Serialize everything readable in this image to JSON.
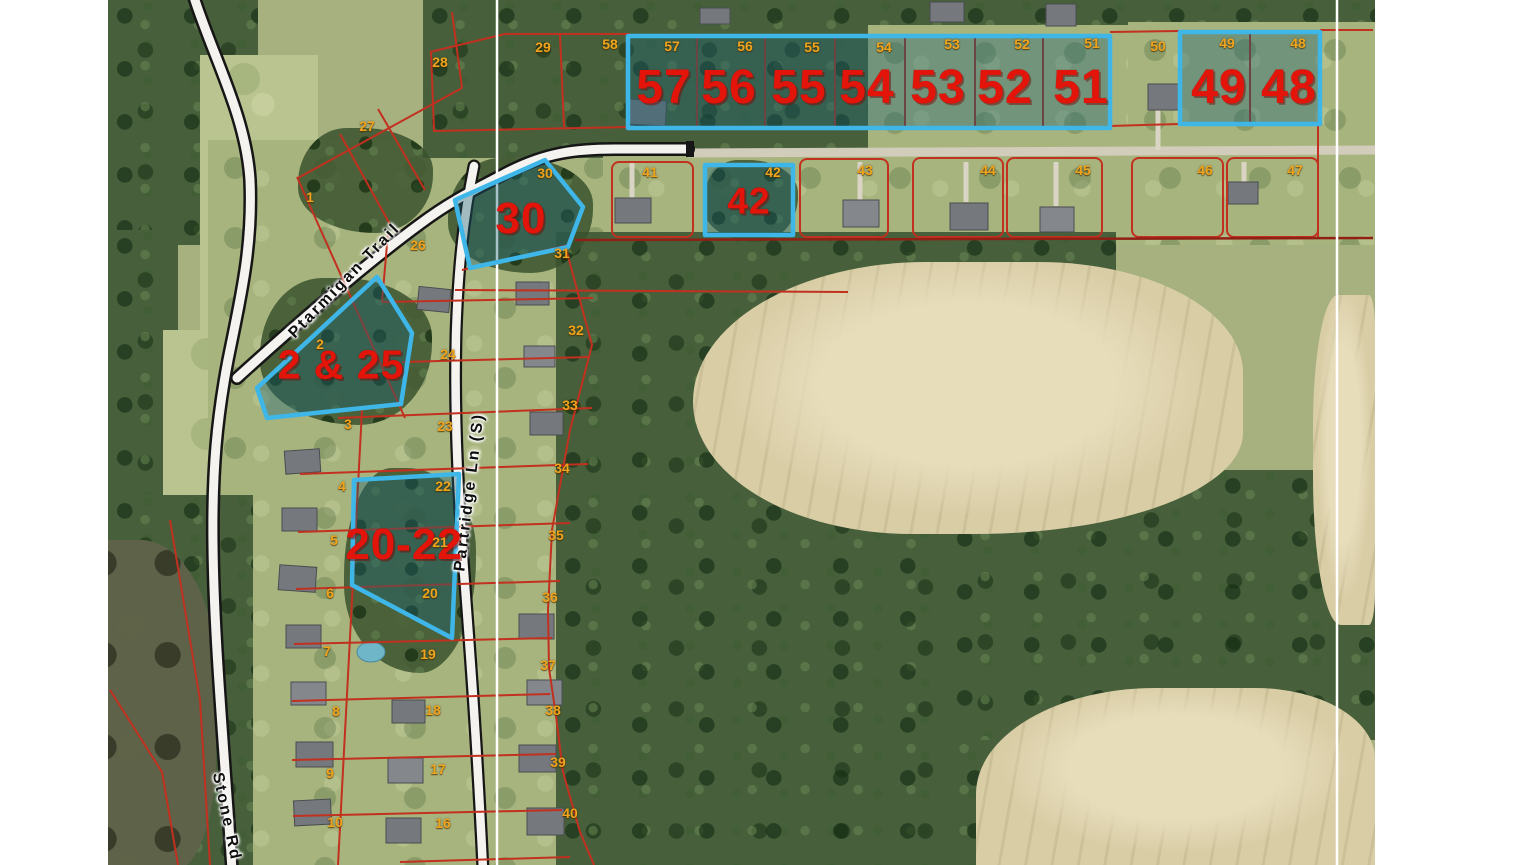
{
  "map": {
    "description": "Aerial plat map with red parcel boundaries and blue-highlighted lots for sale",
    "streets": {
      "ptarmigan": "Ptarmigan Trail",
      "partridge": "Partridge Ln (S)",
      "stone": "Stone Rd"
    },
    "highlighted_parcels": [
      {
        "label": "57"
      },
      {
        "label": "56"
      },
      {
        "label": "55"
      },
      {
        "label": "54"
      },
      {
        "label": "53"
      },
      {
        "label": "52"
      },
      {
        "label": "51"
      },
      {
        "label": "49"
      },
      {
        "label": "48"
      },
      {
        "label": "30"
      },
      {
        "label": "42"
      },
      {
        "label": "2 & 25"
      },
      {
        "label": "20-22"
      }
    ],
    "lot_numbers": [
      {
        "n": "29"
      },
      {
        "n": "58"
      },
      {
        "n": "28"
      },
      {
        "n": "27"
      },
      {
        "n": "1"
      },
      {
        "n": "57"
      },
      {
        "n": "56"
      },
      {
        "n": "55"
      },
      {
        "n": "54"
      },
      {
        "n": "53"
      },
      {
        "n": "52"
      },
      {
        "n": "51"
      },
      {
        "n": "50"
      },
      {
        "n": "49"
      },
      {
        "n": "48"
      },
      {
        "n": "41"
      },
      {
        "n": "42"
      },
      {
        "n": "43"
      },
      {
        "n": "44"
      },
      {
        "n": "45"
      },
      {
        "n": "46"
      },
      {
        "n": "47"
      },
      {
        "n": "30"
      },
      {
        "n": "31"
      },
      {
        "n": "26"
      },
      {
        "n": "2"
      },
      {
        "n": "24"
      },
      {
        "n": "23"
      },
      {
        "n": "22"
      },
      {
        "n": "21"
      },
      {
        "n": "20"
      },
      {
        "n": "19"
      },
      {
        "n": "18"
      },
      {
        "n": "17"
      },
      {
        "n": "16"
      },
      {
        "n": "3"
      },
      {
        "n": "4"
      },
      {
        "n": "5"
      },
      {
        "n": "6"
      },
      {
        "n": "7"
      },
      {
        "n": "8"
      },
      {
        "n": "9"
      },
      {
        "n": "10"
      },
      {
        "n": "32"
      },
      {
        "n": "33"
      },
      {
        "n": "34"
      },
      {
        "n": "35"
      },
      {
        "n": "36"
      },
      {
        "n": "37"
      },
      {
        "n": "38"
      },
      {
        "n": "39"
      },
      {
        "n": "40"
      }
    ],
    "colors": {
      "parcel_line": "#c2301f",
      "highlight_stroke": "#3fb6e8",
      "highlight_fill": "rgba(26,96,116,0.38)",
      "parcel_number_text": "#e3150a",
      "lot_number_text": "#f0a41c"
    }
  }
}
